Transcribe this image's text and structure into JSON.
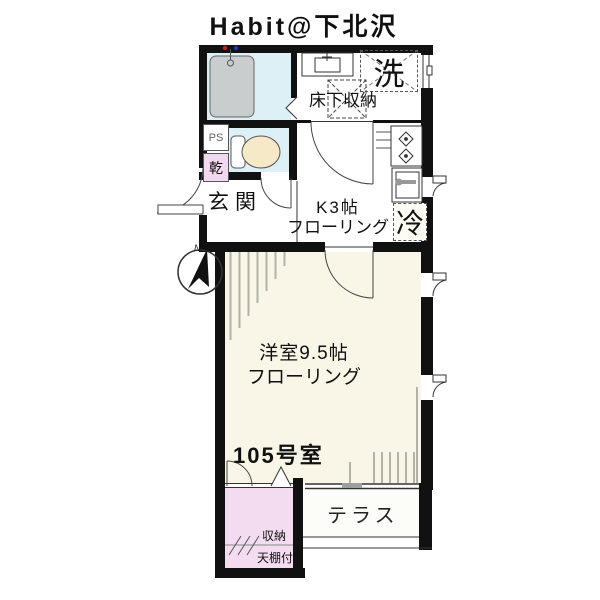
{
  "plan": {
    "title": "Habit@下北沢",
    "room_number": "105号室",
    "north_label": "N",
    "areas": {
      "pipe_space": "PS",
      "dryer": "乾",
      "laundry": "洗",
      "underfloor_storage": "床下収納",
      "entrance": "玄関",
      "kitchen_size": "K3帖",
      "kitchen_floor": "フローリング",
      "fridge": "冷",
      "main_room_size": "洋室9.5帖",
      "main_room_floor": "フローリング",
      "terrace": "テラス",
      "closet": "収納",
      "closet_note": "天棚付"
    },
    "colors": {
      "wall": "#111111",
      "wet_area_blue": "#ddf0f6",
      "room_cream": "#f9f6e7",
      "closet_pink": "#f4dcf0",
      "tub_gray": "#c9cdce",
      "toilet_cream": "#f5e9c8"
    }
  }
}
